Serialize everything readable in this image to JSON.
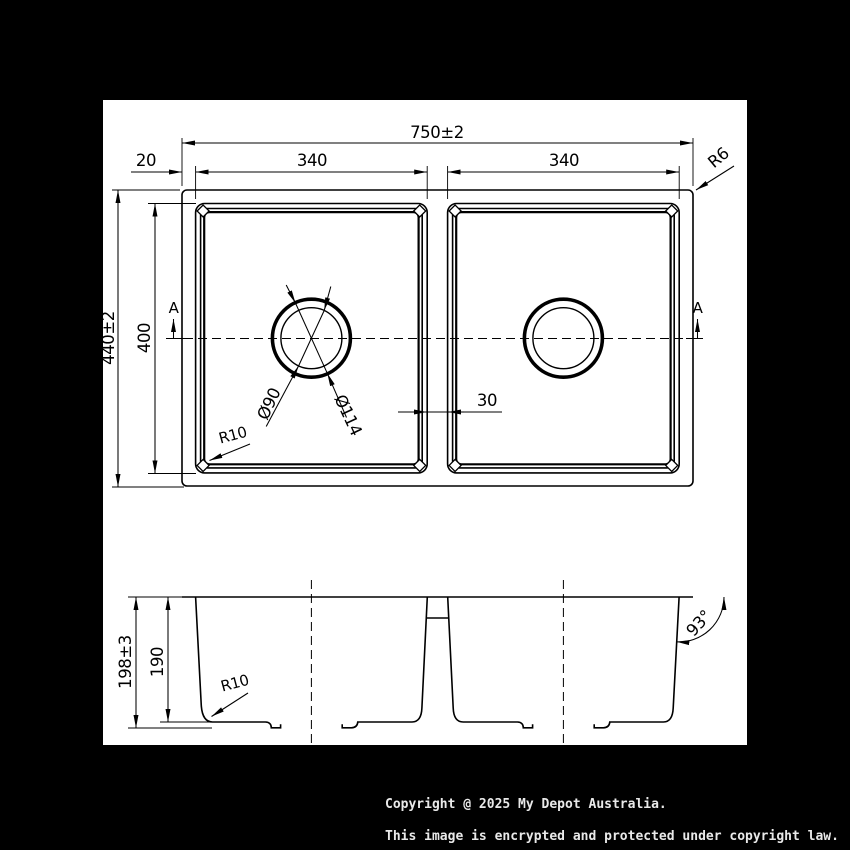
{
  "colors": {
    "background": "#000000",
    "paper": "#ffffff",
    "line": "#000000",
    "footer_text": "#e9e9e9"
  },
  "plan": {
    "overall_width": "750±2",
    "rim_margin": "20",
    "bowl_width_left": "340",
    "bowl_width_right": "340",
    "rim_corner_radius": "R6",
    "overall_depth": "440±2",
    "bowl_depth": "400",
    "divider_width": "30",
    "bowl_corner_radius": "R10",
    "drain_inner_dia": "Ø90",
    "drain_outer_dia": "Ø114",
    "section_label_left": "A",
    "section_label_right": "A"
  },
  "section": {
    "overall_height": "198±3",
    "bowl_inner_depth": "190",
    "bottom_corner_radius": "R10",
    "wall_angle": "93°"
  },
  "footer": {
    "line1": "Copyright @ 2025 My Depot Australia.",
    "line2": "This image is encrypted and protected under copyright law."
  }
}
